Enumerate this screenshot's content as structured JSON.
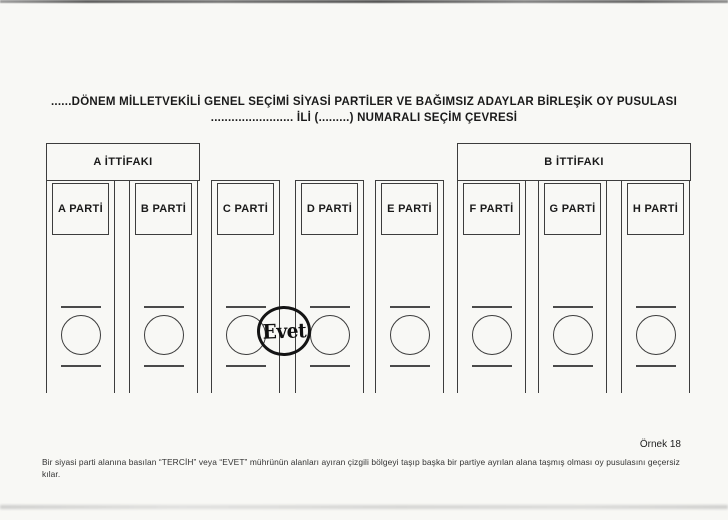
{
  "document": {
    "title_line1": "......DÖNEM MİLLETVEKİLİ GENEL SEÇİMİ SİYASİ PARTİLER VE BAĞIMSIZ ADAYLAR BİRLEŞİK OY PUSULASI",
    "title_line2": "........................ İLİ (.........) NUMARALI SEÇİM ÇEVRESİ"
  },
  "ballot": {
    "alliances": [
      {
        "label": "A İTTİFAKI",
        "member_parties": [
          "A PARTİ",
          "B PARTİ"
        ]
      },
      {
        "label": "B İTTİFAKI",
        "member_parties": [
          "F PARTİ",
          "G PARTİ",
          "H PARTİ"
        ]
      }
    ],
    "party_columns": [
      {
        "label": "A PARTİ"
      },
      {
        "label": "B PARTİ"
      },
      {
        "label": "C PARTİ"
      },
      {
        "label": "D PARTİ"
      },
      {
        "label": "E PARTİ"
      },
      {
        "label": "F PARTİ"
      },
      {
        "label": "G PARTİ"
      },
      {
        "label": "H PARTİ"
      }
    ],
    "stamp": {
      "label": "Evet",
      "between": [
        "C PARTİ",
        "D PARTİ"
      ]
    }
  },
  "footer": {
    "example_number": "Örnek 18",
    "note_line1": "Bir siyasi parti alanına basılan “TERCİH” veya “EVET” mührünün alanları ayıran çizgili bölgeyi taşıp başka bir partiye  ayrılan alana taşmış olması oy pusulasını geçersiz",
    "note_line2": "kılar."
  },
  "colors": {
    "paper": "#f8f8f5",
    "ink": "#2b2b2b"
  }
}
